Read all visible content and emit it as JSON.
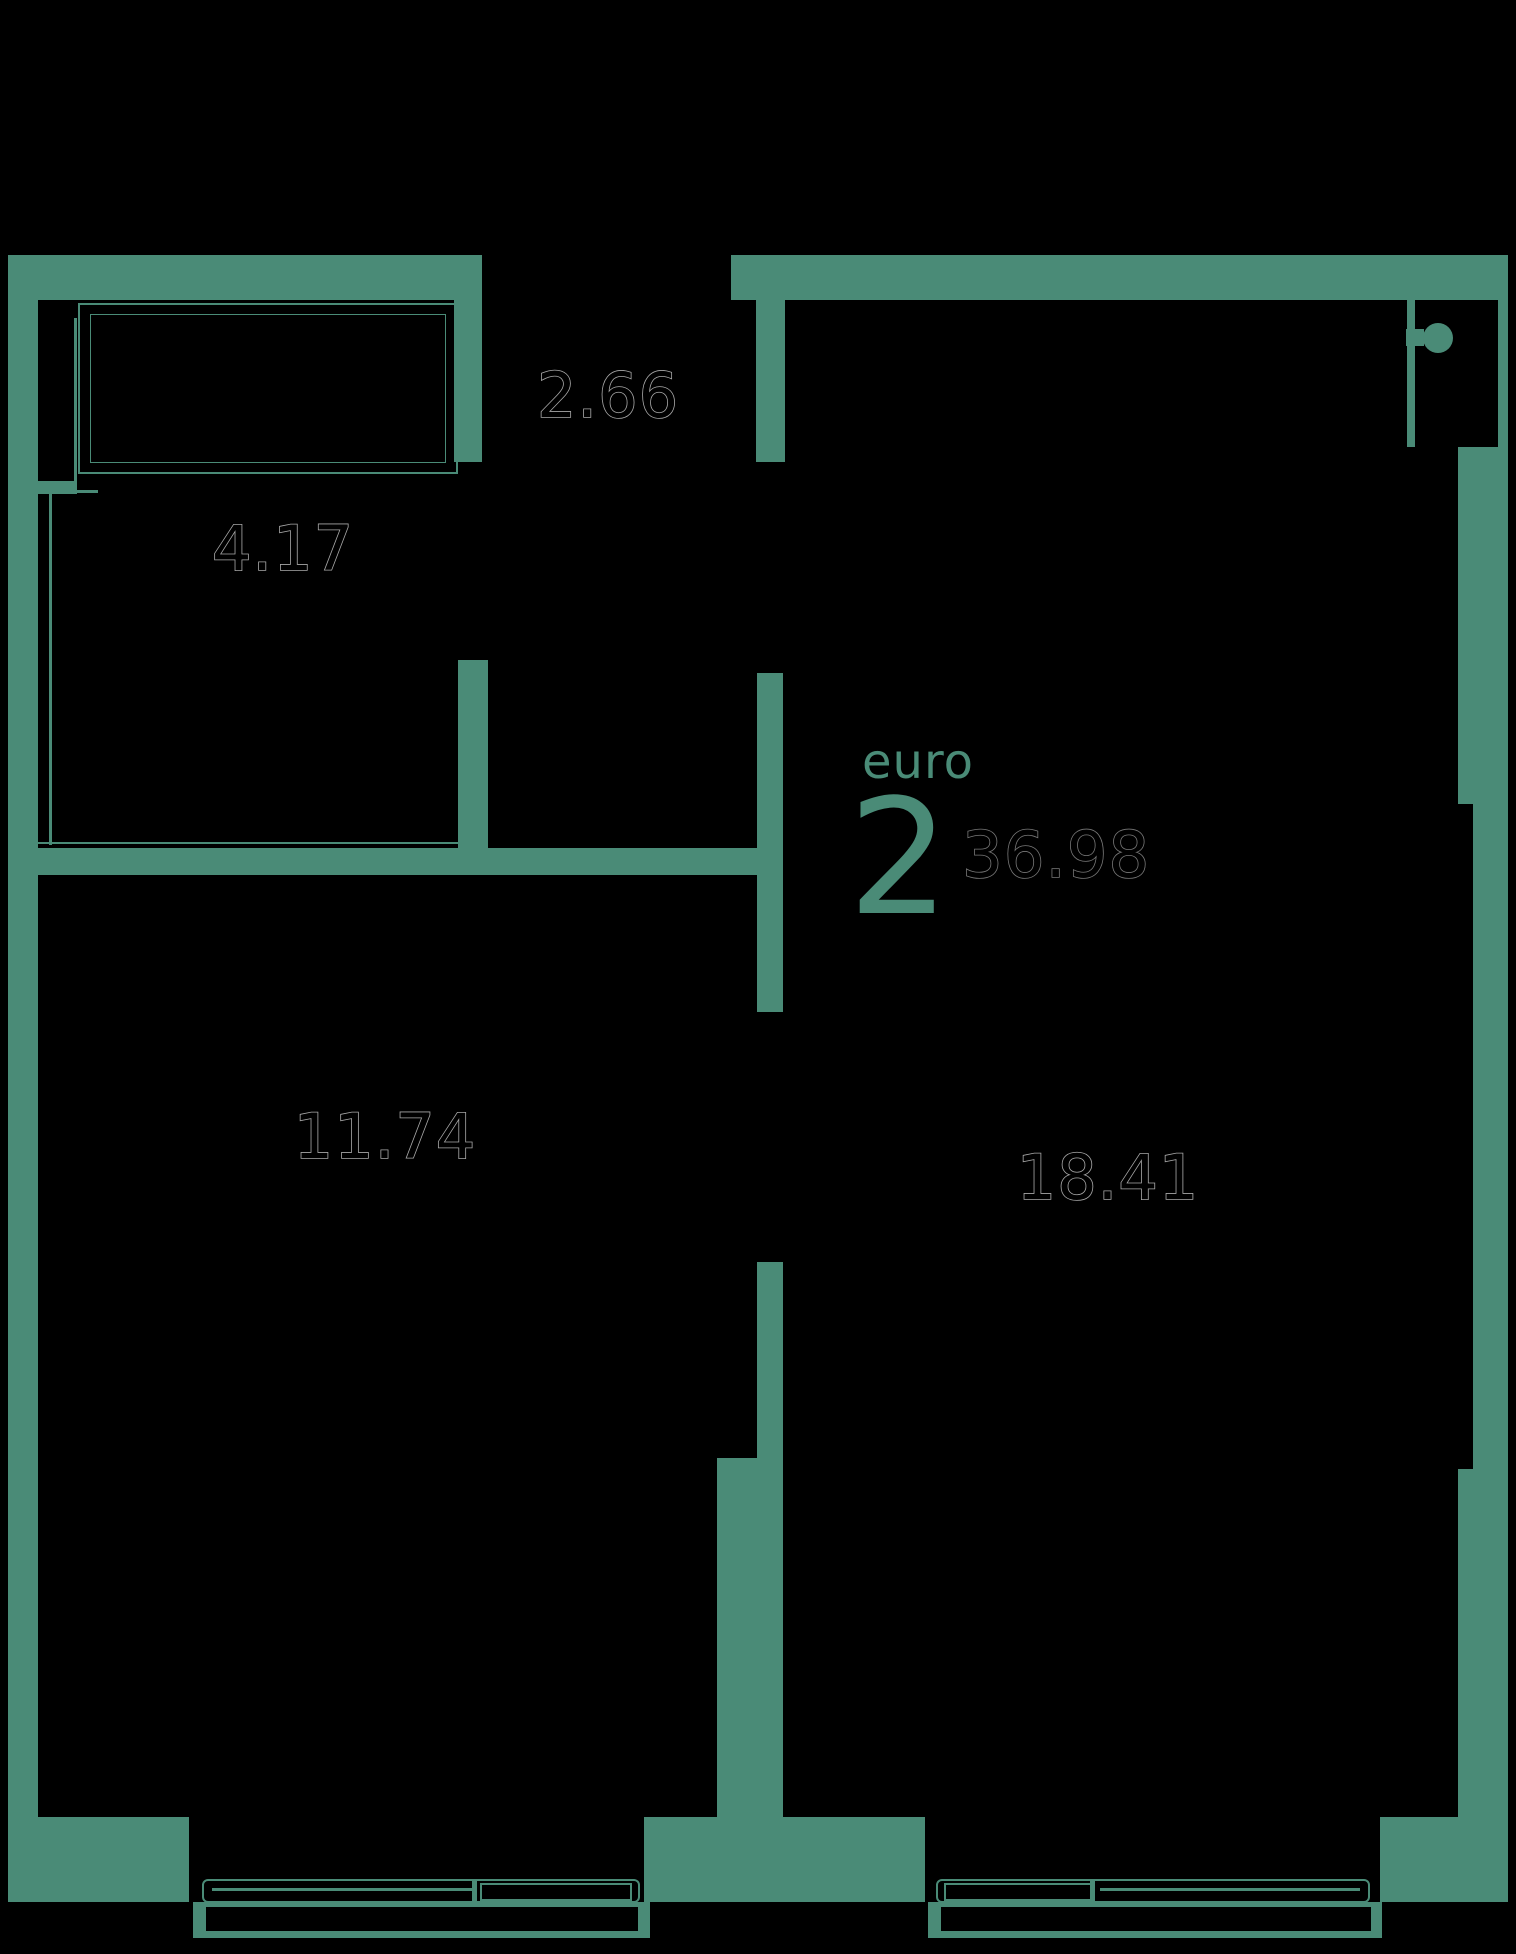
{
  "floor_plan": {
    "layout_type_label": "euro",
    "room_count": "2",
    "total_area": "36.98",
    "room_areas": {
      "wardrobe": "4.17",
      "loggia": "2.66",
      "bedroom": "11.74",
      "living_kitchen": "18.41"
    },
    "colors": {
      "wall": "#4a8b77",
      "background": "#000000",
      "room_label_outline": "#a8a8a8",
      "total_area_outline": "#777777"
    }
  }
}
